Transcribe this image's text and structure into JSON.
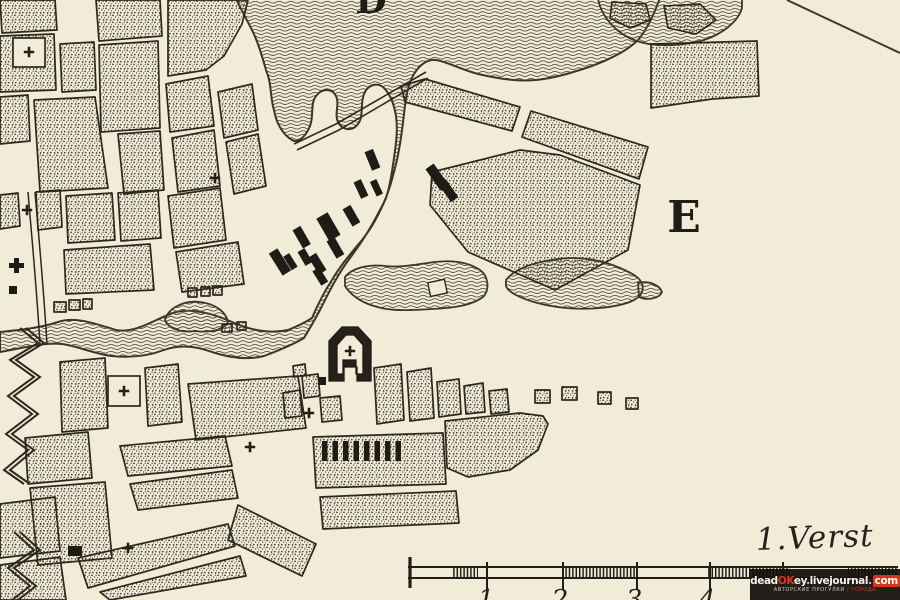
{
  "map": {
    "paper_color": "#f1ecd8",
    "ink_color": "#2a2720",
    "labels": {
      "letter_top": "D",
      "letter_plain": "E"
    },
    "scale_bar": {
      "label": "1.Verst",
      "tick_numbers": [
        "1",
        "2",
        "3",
        "4"
      ]
    }
  },
  "watermark": {
    "site_parts": [
      "dead",
      "OK",
      "ey",
      ".",
      "livejournal",
      ".",
      "com"
    ],
    "tagline_left": "АВТОРСКИЕ ПРОГУЛКИ",
    "tagline_right": "/ ГОРОДА",
    "red_color": "#d93418",
    "bg_color": "#14100c"
  }
}
